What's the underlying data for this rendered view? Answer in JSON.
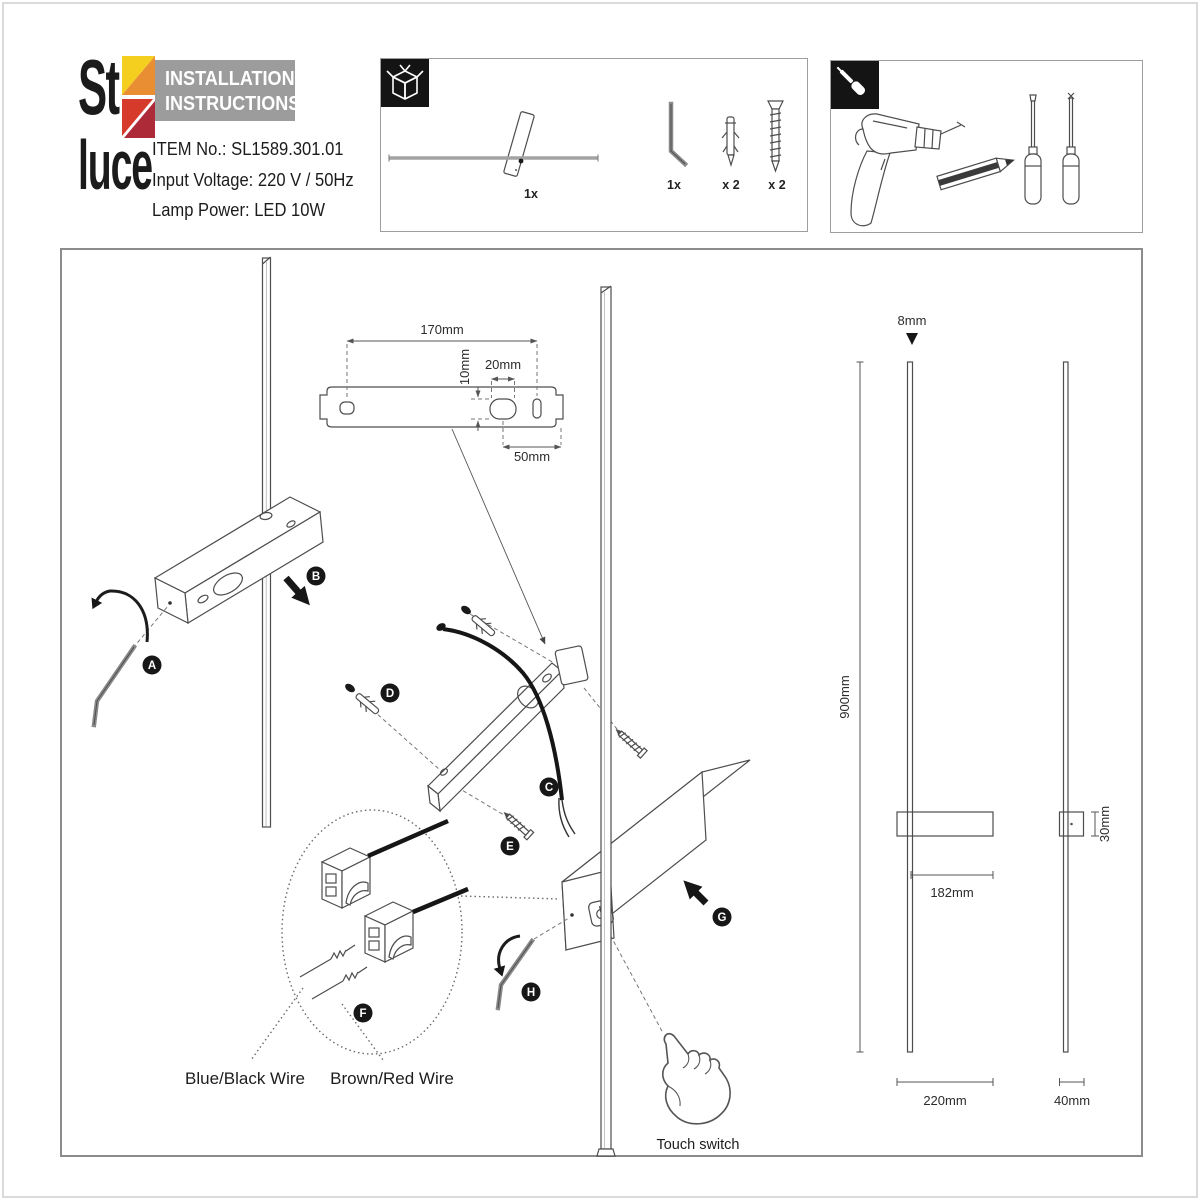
{
  "brand": {
    "logo_top": "St",
    "logo_bottom": "luce",
    "colors": {
      "yellow": "#f4cf1f",
      "orange": "#e98e33",
      "red": "#d63a2a",
      "crimson": "#ad2a38"
    }
  },
  "header": {
    "line1": "INSTALLATION",
    "line2": "INSTRUCTIONS",
    "bg": "#9c9c9c"
  },
  "product": {
    "item_label": "ITEM No.:",
    "item_value": "SL1589.301.01",
    "voltage_label": "Input Voltage:",
    "voltage_value": "220 V / 50Hz",
    "power_label": "Lamp Power:",
    "power_value": "LED 10W"
  },
  "package_panel": {
    "icon": "package-icon",
    "lamp_qty": "1x",
    "allen_key_qty": "1x",
    "wall_plug_qty": "x 2",
    "screw_qty": "x 2"
  },
  "tools_panel": {
    "icon": "screwdriver-icon",
    "tools": [
      "drill",
      "pencil",
      "flat-screwdriver",
      "phillips-screwdriver"
    ]
  },
  "steps": {
    "a": "A",
    "b": "B",
    "c": "C",
    "d": "D",
    "e": "E",
    "f": "F",
    "g": "G",
    "h": "H"
  },
  "bracket_dims": {
    "width": "170mm",
    "hole_h": "10mm",
    "hole_w": "20mm",
    "offset": "50mm"
  },
  "lamp_dims": {
    "rod": "8mm",
    "height": "900mm",
    "body_w": "182mm",
    "body_h": "30mm",
    "width": "220mm",
    "depth": "40mm"
  },
  "labels": {
    "blue_black": "Blue/Black Wire",
    "brown_red": "Brown/Red Wire",
    "touch": "Touch switch"
  }
}
